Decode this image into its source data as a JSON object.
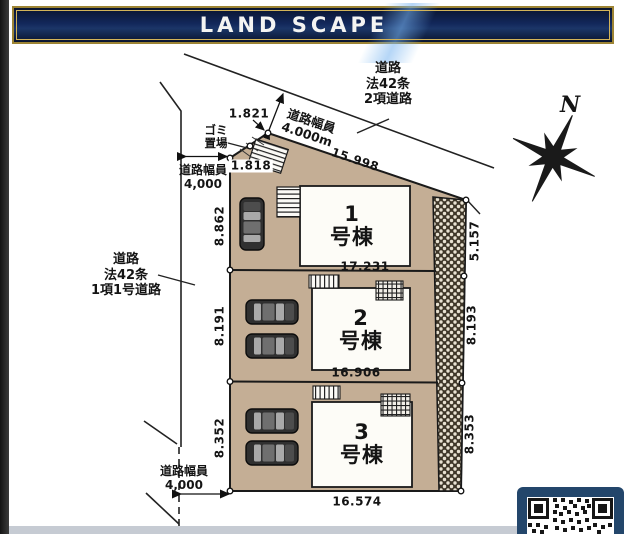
{
  "banner": {
    "title": "LAND SCAPE"
  },
  "compass": {
    "label": "N"
  },
  "roads": {
    "top": {
      "line1": "道路",
      "line2": "法42条",
      "line3": "2項道路",
      "width_label": "道路幅員",
      "width_value": "4.000m"
    },
    "left": {
      "line1": "道路",
      "line2": "法42条",
      "line3": "1項1号道路",
      "width_label": "道路幅員",
      "width_value": "4,000"
    },
    "bottom": {
      "width_label": "道路幅員",
      "width_value": "4,000"
    }
  },
  "garbage": {
    "line1": "ゴミ",
    "line2": "置場"
  },
  "buildings": [
    {
      "number": "1",
      "suffix": "号棟"
    },
    {
      "number": "2",
      "suffix": "号棟"
    },
    {
      "number": "3",
      "suffix": "号棟"
    }
  ],
  "dimensions": {
    "top_edge": "15.998",
    "chamfer_upper": "1.821",
    "chamfer_lower": "1.818",
    "left": [
      "8.862",
      "8.191",
      "8.352"
    ],
    "right": [
      "5.157",
      "8.193",
      "8.353"
    ],
    "widths": [
      "17.231",
      "16.906",
      "16.574"
    ]
  },
  "colors": {
    "banner_navy": "#12275a",
    "banner_gold": "#c9ab4c",
    "lot_tan": "#c4ae95",
    "slope_hatch_dark": "#3f3729",
    "qr_frame_navy": "#23466b"
  }
}
